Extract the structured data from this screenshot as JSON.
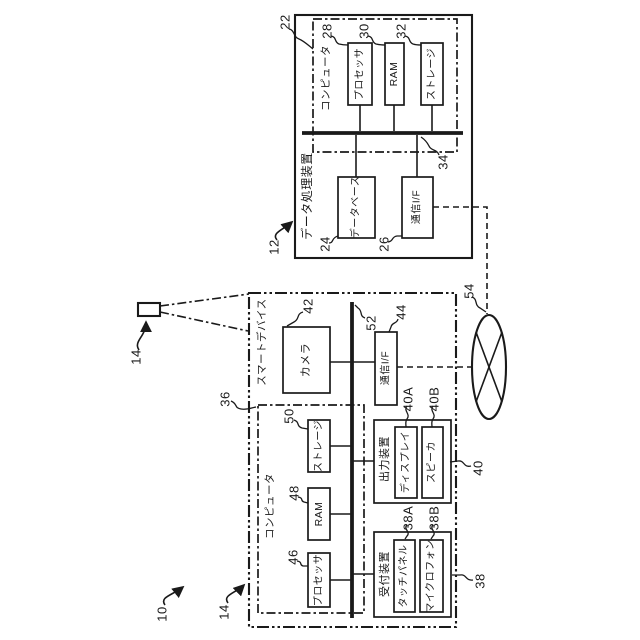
{
  "figure": {
    "colors": {
      "line": "#1a1a1a",
      "background": "#ffffff"
    },
    "system": {
      "ref": "10"
    },
    "data_processing_device": {
      "ref": "12",
      "title": "データ処理装置",
      "computer": {
        "ref": "22",
        "label": "コンピュータ"
      },
      "processor": {
        "ref": "28",
        "label": "プロセッサ"
      },
      "ram": {
        "ref": "30",
        "label": "RAM"
      },
      "storage": {
        "ref": "32",
        "label": "ストレージ"
      },
      "bus": {
        "ref": "34"
      },
      "database": {
        "ref": "24",
        "label": "データベース"
      },
      "comm_if": {
        "ref": "26",
        "label": "通信I/F"
      }
    },
    "smart_device": {
      "ref": "14",
      "title": "スマートデバイス",
      "camera": {
        "ref": "42",
        "label": "カメラ"
      },
      "comm_if": {
        "ref": "44",
        "label": "通信I/F"
      },
      "bus": {
        "ref": "52"
      },
      "computer": {
        "ref": "36",
        "label": "コンピュータ"
      },
      "processor": {
        "ref": "46",
        "label": "プロセッサ"
      },
      "ram": {
        "ref": "48",
        "label": "RAM"
      },
      "storage": {
        "ref": "50",
        "label": "ストレージ"
      },
      "output_device": {
        "ref": "40",
        "label": "出力装置"
      },
      "display": {
        "ref": "40A",
        "label": "ディスプレイ"
      },
      "speaker": {
        "ref": "40B",
        "label": "スピーカ"
      },
      "reception_device": {
        "ref": "38",
        "label": "受付装置"
      },
      "touch_panel": {
        "ref": "38A",
        "label": "タッチパネル"
      },
      "microphone": {
        "ref": "38B",
        "label": "マイクロフォン"
      }
    },
    "network": {
      "ref": "54"
    }
  }
}
